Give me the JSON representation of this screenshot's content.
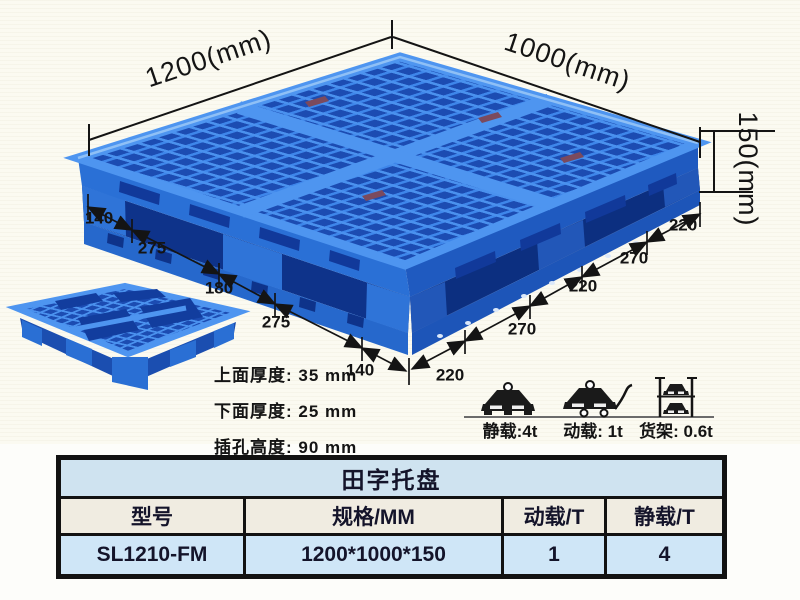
{
  "diagram": {
    "overall_length_label": "1200(mm)",
    "overall_width_label": "1000(mm)",
    "overall_height_label": "150(mm)",
    "left_edge_segments": [
      "140",
      "275",
      "180",
      "275",
      "140"
    ],
    "right_edge_segments": [
      "220",
      "270",
      "220",
      "270",
      "220"
    ]
  },
  "specs": {
    "lines": [
      "上面厚度: 35 mm",
      "下面厚度: 25 mm",
      "插孔高度: 90 mm"
    ]
  },
  "load_ratings": [
    {
      "icon": "static-load-icon",
      "label": "静载:4t"
    },
    {
      "icon": "dynamic-load-icon",
      "label": "动载: 1t"
    },
    {
      "icon": "rack-load-icon",
      "label": "货架: 0.6t"
    }
  ],
  "table": {
    "title": "田字托盘",
    "headers": [
      "型号",
      "规格/MM",
      "动载/T",
      "静载/T"
    ],
    "rows": [
      [
        "SL1210-FM",
        "1200*1000*150",
        "1",
        "4"
      ]
    ]
  },
  "colors": {
    "pallet_blue": "#2e7ce2",
    "pallet_rib_light": "#4a91ee",
    "pallet_hole_dark": "#1c4cb2",
    "pallet_inner_dark": "#0e338a",
    "dimension_line": "#141414",
    "table_title_bg": "#cfe3f0",
    "table_header_bg": "#f0ece1",
    "table_row_bg": "#cfe6f7"
  }
}
